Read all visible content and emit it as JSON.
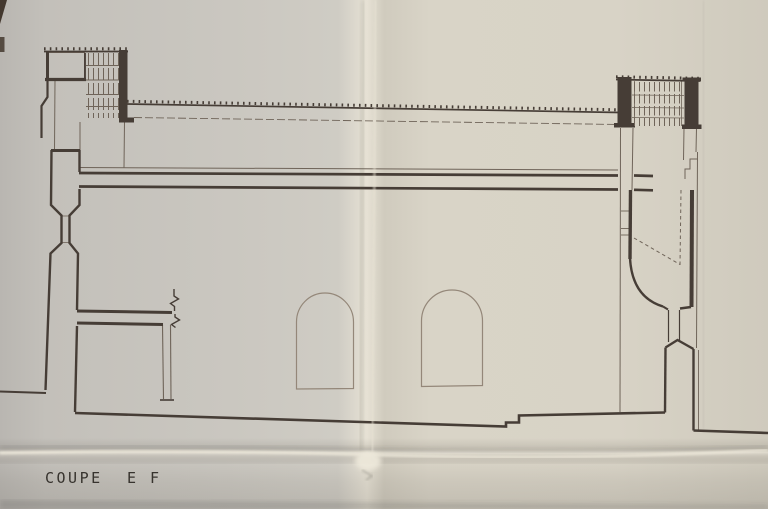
{
  "drawing": {
    "title_word1": "COUPE",
    "title_word2": "E F"
  },
  "colors": {
    "paper_left": "#c6c3bd",
    "paper_right": "#d7d2c5",
    "fold_highlight": "#ebe6d8",
    "ink_dark": "#463d36",
    "ink_medium": "#6f6459",
    "ink_light": "#948779",
    "title_text": "#37332e",
    "corner_shadow": "#43382e"
  }
}
